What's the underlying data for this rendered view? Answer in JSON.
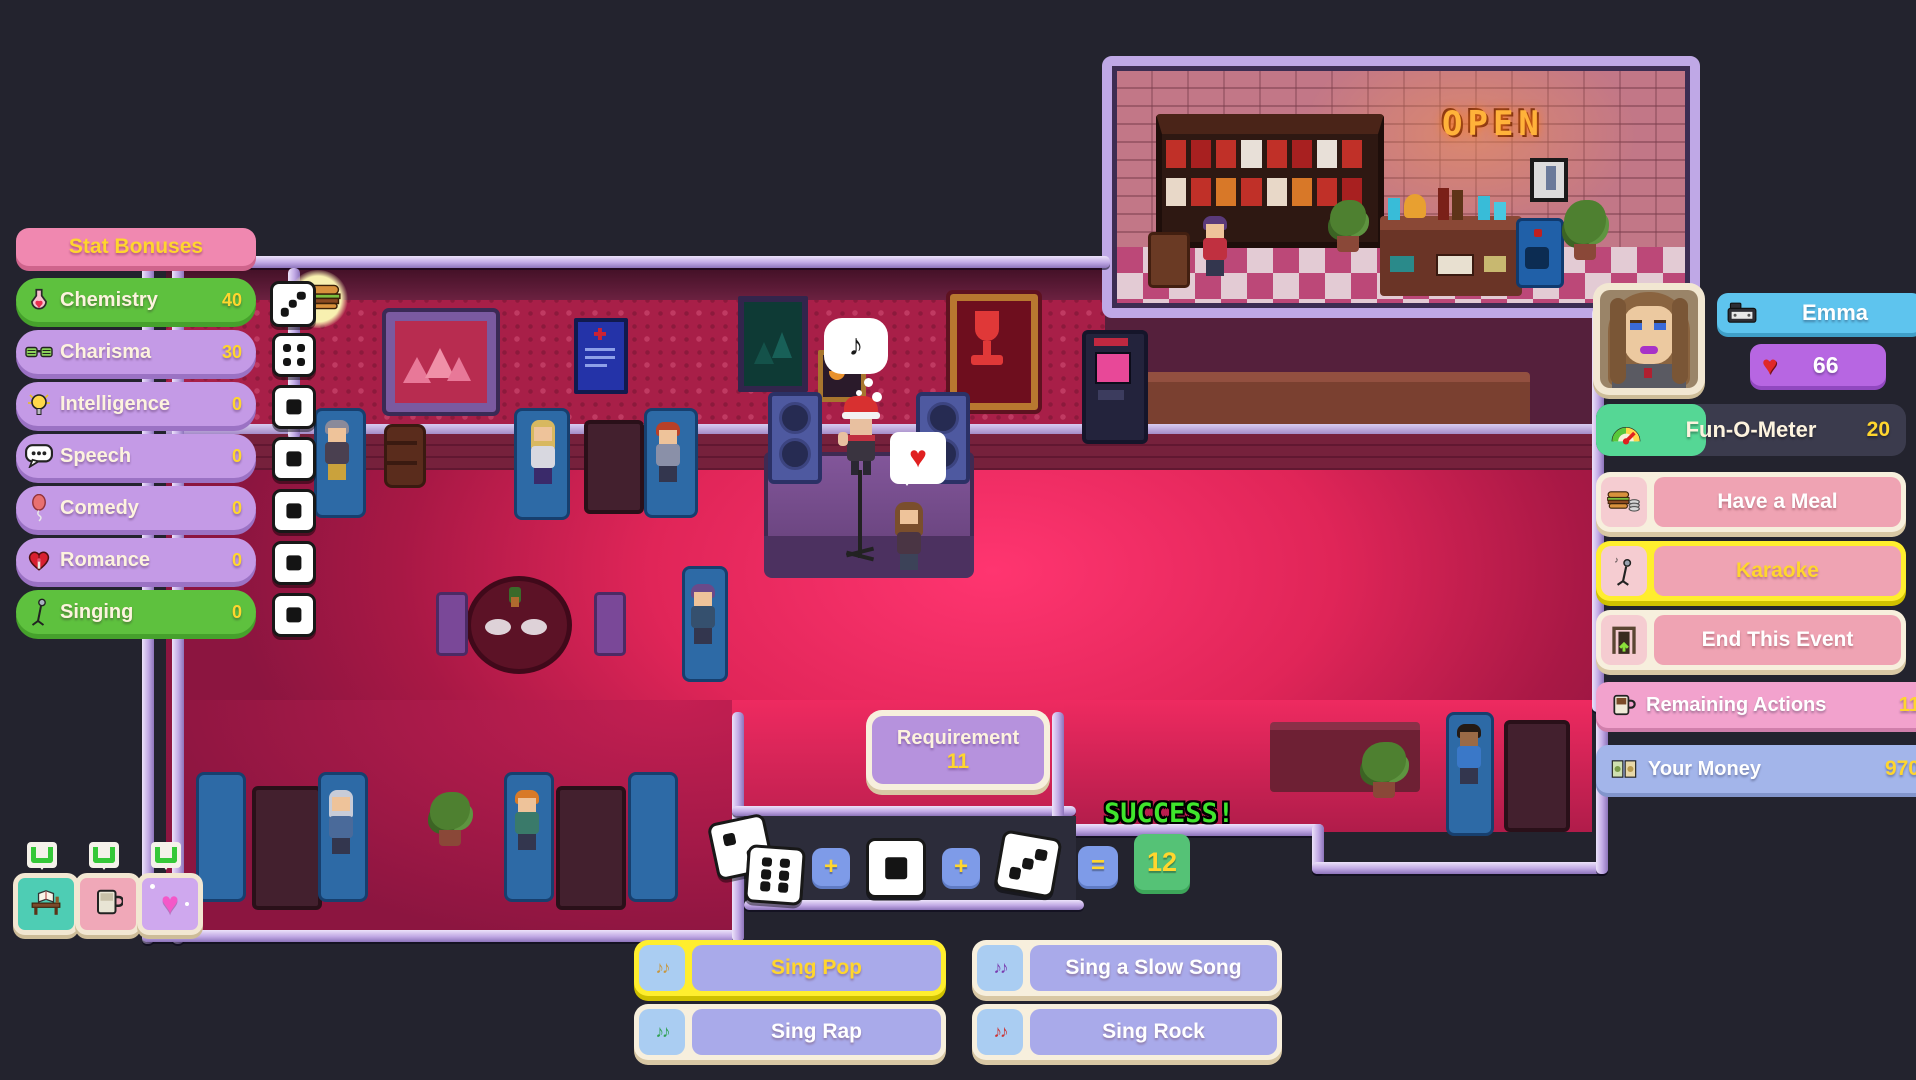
{
  "ui_colors": {
    "pill_green": "#5ec13e",
    "pill_purple": "#c49ae6",
    "pill_pink": "#f088b0",
    "value_yellow": "#ffd62e",
    "cream": "#f7efdd",
    "button_pink": "#efa3b3",
    "highlight_yellow": "#ffee2e",
    "song_blue": "#a9aaea",
    "name_blue": "#5ec4ee",
    "money_blue": "#a3b5ea",
    "fun_green": "#55d795",
    "success_green": "#3fe52c",
    "floor_pink": "#f22960"
  },
  "stat_panel": {
    "title": "Stat Bonuses",
    "stats": [
      {
        "label": "Chemistry",
        "value": "40",
        "icon": "chemistry-flask-icon",
        "die_pips": 3,
        "has_bonus_marker": true,
        "bonus_icon": "burger-icon"
      },
      {
        "label": "Charisma",
        "value": "30",
        "icon": "party-glasses-icon",
        "die_pips": 4
      },
      {
        "label": "Intelligence",
        "value": "0",
        "icon": "lightbulb-icon",
        "die_pips": 1
      },
      {
        "label": "Speech",
        "value": "0",
        "icon": "speech-bubble-icon",
        "die_pips": 1
      },
      {
        "label": "Comedy",
        "value": "0",
        "icon": "balloon-icon",
        "die_pips": 1
      },
      {
        "label": "Romance",
        "value": "0",
        "icon": "heart-rose-icon",
        "die_pips": 1
      },
      {
        "label": "Singing",
        "value": "0",
        "icon": "microphone-stand-icon",
        "die_pips": 1
      }
    ]
  },
  "character_panel": {
    "name": "Emma",
    "affection": "66",
    "fun_meter": {
      "label": "Fun-O-Meter",
      "value": "20"
    },
    "buttons": [
      {
        "label": "Have a Meal",
        "icon": "meal-icon",
        "highlighted": false
      },
      {
        "label": "Karaoke",
        "icon": "karaoke-mic-icon",
        "highlighted": true
      },
      {
        "label": "End This Event",
        "icon": "exit-door-icon",
        "highlighted": false
      }
    ],
    "remaining_actions": {
      "label": "Remaining Actions",
      "value": "11"
    },
    "money": {
      "label": "Your Money",
      "value": "970"
    }
  },
  "dice_check": {
    "requirement": {
      "label": "Requirement",
      "value": "11"
    },
    "result": "SUCCESS!",
    "equation": {
      "dice": [
        2,
        6,
        1,
        3
      ],
      "plus": "+",
      "equals": "=",
      "total": "12"
    }
  },
  "song_menu": [
    {
      "label": "Sing Pop",
      "icon": "music-notes-icon",
      "note_color": "#c8963c",
      "highlighted": true
    },
    {
      "label": "Sing a Slow Song",
      "icon": "music-notes-icon",
      "note_color": "#7a3cb0",
      "highlighted": false
    },
    {
      "label": "Sing Rap",
      "icon": "music-notes-icon",
      "note_color": "#2ea050",
      "highlighted": false
    },
    {
      "label": "Sing Rock",
      "icon": "music-notes-icon",
      "note_color": "#cc3434",
      "highlighted": false
    }
  ],
  "hotspot_chips": [
    {
      "icon": "desk-book-icon",
      "bg": "#4ecdb4"
    },
    {
      "icon": "mug-icon",
      "bg": "#f0a8b8"
    },
    {
      "icon": "sparkle-heart-icon",
      "bg": "#cfa8ee"
    }
  ],
  "scene": {
    "open_sign": "OPEN",
    "speech_bubble": "♪",
    "heart_bubble": "♥"
  }
}
